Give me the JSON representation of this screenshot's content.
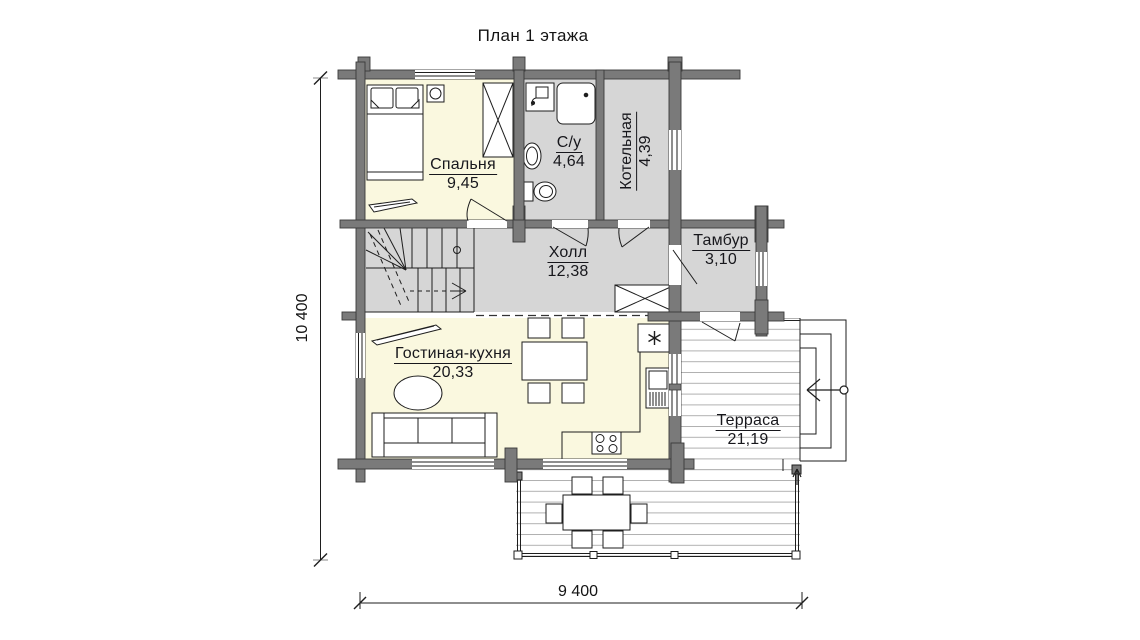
{
  "title": "План 1 этажа",
  "rooms": {
    "bedroom": {
      "name": "Спальня",
      "area": "9,45"
    },
    "bathroom": {
      "name": "С/у",
      "area": "4,64"
    },
    "boiler": {
      "name": "Котельная",
      "area": "4,39"
    },
    "hall": {
      "name": "Холл",
      "area": "12,38"
    },
    "vestibule": {
      "name": "Тамбур",
      "area": "3,10"
    },
    "living_kitchen": {
      "name": "Гостиная-кухня",
      "area": "20,33"
    },
    "terrace": {
      "name": "Терраса",
      "area": "21,19"
    }
  },
  "dimensions": {
    "vertical": "10 400",
    "horizontal": "9 400"
  },
  "icons": {
    "fridge": "asterisk-star",
    "stove": "four-burner-circles",
    "entry": "arrow-with-circle"
  },
  "colors": {
    "warm_room_fill": "#faf8df",
    "cold_room_fill": "#d6d6d6",
    "wall_fill": "#7a7a7a",
    "wall_stroke": "#3a3a3a",
    "deck_line": "#b0b0b0",
    "line": "#1e1e1e"
  }
}
